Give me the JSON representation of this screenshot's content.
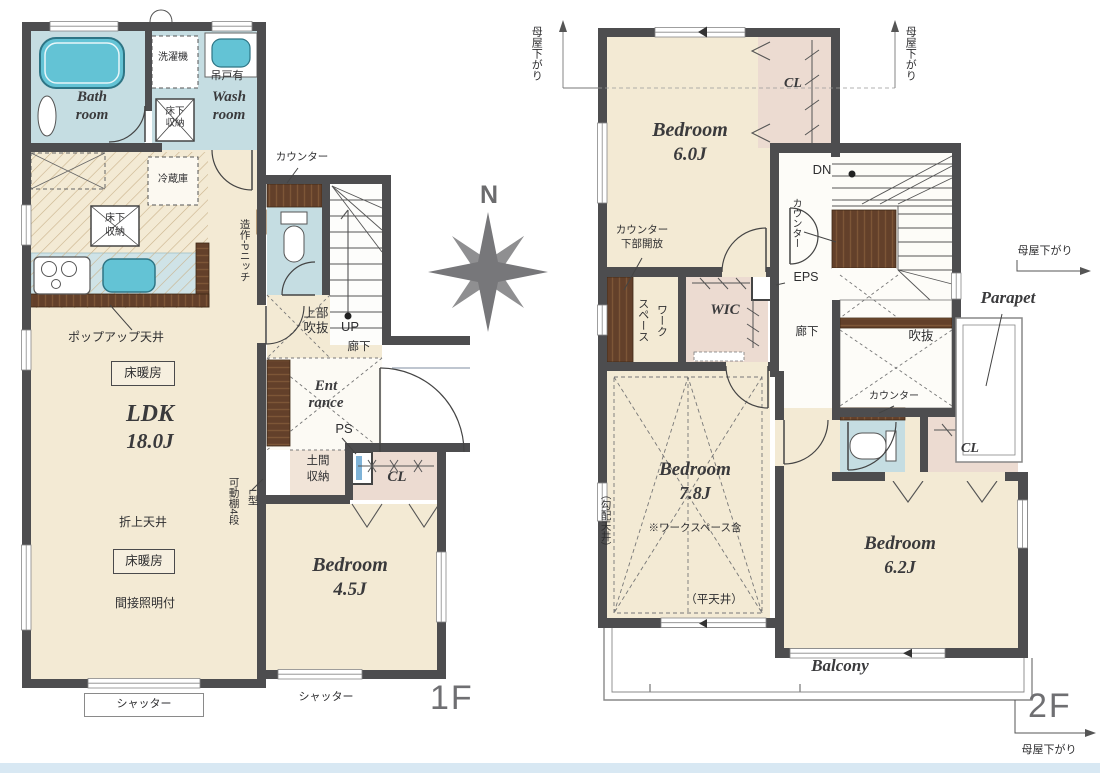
{
  "compass": {
    "north": "N"
  },
  "f1": {
    "floor_label": "1F",
    "washer": "洗濯機",
    "hanging_cabinet": "吊戸有",
    "bath": [
      "Bath",
      "room"
    ],
    "wash": [
      "Wash",
      "room"
    ],
    "underfloor_storage_wash": [
      "床下",
      "収納"
    ],
    "fridge": "冷蔵庫",
    "underfloor_storage_kitchen": [
      "床下",
      "収納"
    ],
    "counter": "カウンター",
    "niche": "造作-Pニッチ",
    "popup_ceiling": "ポップアップ天井",
    "floor_heating_kitchen": "床暖房",
    "ldk": [
      "LDK",
      "18.0J"
    ],
    "upper_void": [
      "上部",
      "吹抜"
    ],
    "up": "UP",
    "hallway": "廊下",
    "entrance": [
      "Ent",
      "rance"
    ],
    "ps": "PS",
    "raised_ceiling": "折上天井",
    "floor_heating_living": "床暖房",
    "indirect_lighting": "間接照明付",
    "movable_shelf": "可動棚4段",
    "l_type": "L型",
    "doma_storage": [
      "土間",
      "収納"
    ],
    "closet": "CL",
    "bedroom": [
      "Bedroom",
      "4.5J"
    ],
    "shutter_left": "シャッター",
    "shutter_right": "シャッター"
  },
  "f2": {
    "floor_label": "2F",
    "moya_top_left": "母屋下がり",
    "moya_top_right": "母屋下がり",
    "moya_right": "母屋下がり",
    "moya_bottom": "母屋下がり",
    "bedroom1": [
      "Bedroom",
      "6.0J"
    ],
    "closet1": "CL",
    "dn": "DN",
    "counter_stairs": "カウンター",
    "counter_open": [
      "カウンター",
      "下部開放"
    ],
    "workspace": "ワーク\nスペース",
    "wic": "WIC",
    "eps": "EPS",
    "hallway": "廊下",
    "parapet": "Parapet",
    "void": "吹抜",
    "counter_toilet": "カウンター",
    "closet2": "CL",
    "bedroom2": [
      "Bedroom",
      "7.8J"
    ],
    "bedroom2_note": "※ワークスペース含",
    "sloped_ceiling": "（勾配天井）",
    "flat_ceiling": "（平天井）",
    "bedroom3": [
      "Bedroom",
      "6.2J"
    ],
    "balcony": "Balcony"
  }
}
